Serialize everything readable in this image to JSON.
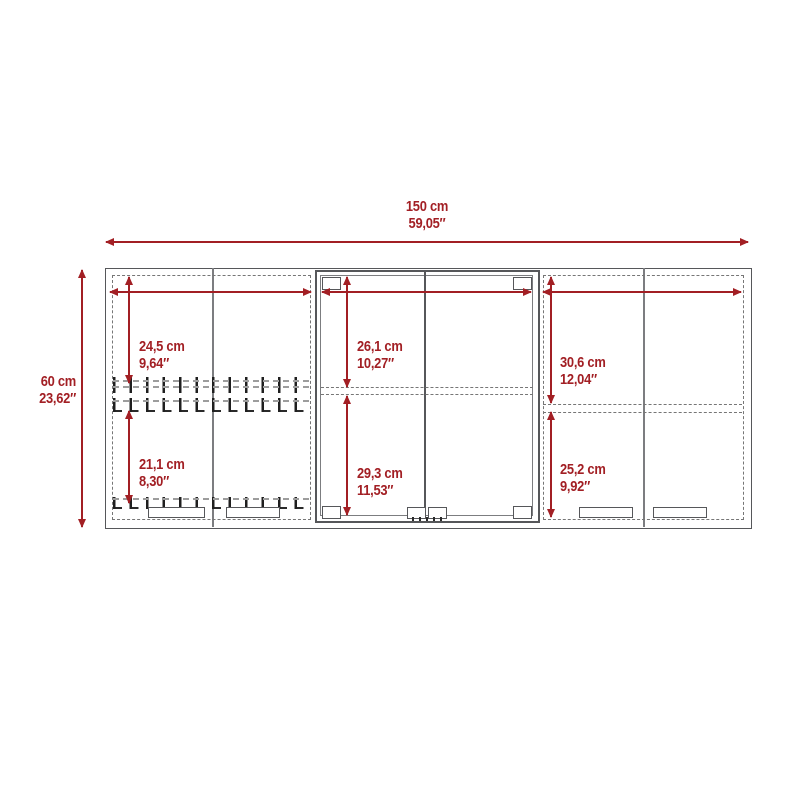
{
  "diagram": {
    "title": "Wall cabinet dimension drawing (front view)",
    "style": {
      "accent_color": "#a21f24",
      "line_color": "#56575a",
      "line_light_color": "#7c7d80",
      "dash_color": "#767676"
    }
  },
  "dimensions": {
    "overall_width": {
      "cm": "150 cm",
      "inch": "59,05″"
    },
    "overall_height": {
      "cm": "60 cm",
      "inch": "23,62″"
    },
    "left_upper": {
      "cm": "24,5 cm",
      "inch": "9,64″"
    },
    "left_lower": {
      "cm": "21,1 cm",
      "inch": "8,30″"
    },
    "center_upper": {
      "cm": "26,1 cm",
      "inch": "10,27″"
    },
    "center_lower": {
      "cm": "29,3 cm",
      "inch": "11,53″"
    },
    "right_upper": {
      "cm": "30,6 cm",
      "inch": "12,04″"
    },
    "right_lower": {
      "cm": "25,2 cm",
      "inch": "9,92″"
    }
  }
}
